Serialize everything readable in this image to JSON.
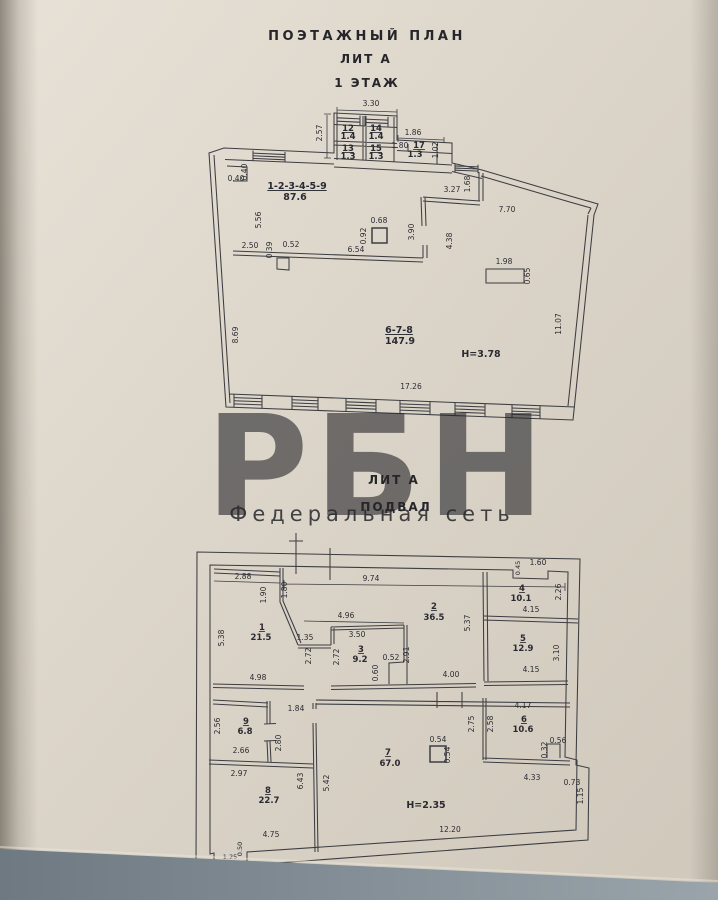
{
  "page": {
    "title_line1": "ПОЭТАЖНЫЙ ПЛАН",
    "title_line2": "ЛИТ А",
    "title_line3": "1 ЭТАЖ",
    "section2_line1": "ЛИТ А",
    "section2_line2": "ПОДВАЛ"
  },
  "watermark": {
    "brand": "РБН",
    "subtitle": "Федеральная сеть",
    "color": "#ef7d8d",
    "subtitle_color": "#8d8d88"
  },
  "floor1": {
    "height_note": "Н=3.78",
    "labels": [
      {
        "t": "3.30",
        "x": 371,
        "y": 106
      },
      {
        "t": "2.57",
        "x": 322,
        "y": 133,
        "r": 1
      },
      {
        "t": "12",
        "x": 348,
        "y": 131,
        "b": 1,
        "u": 1
      },
      {
        "t": "1.4",
        "x": 348,
        "y": 139,
        "b": 1
      },
      {
        "t": "14",
        "x": 376,
        "y": 131,
        "b": 1,
        "u": 1
      },
      {
        "t": "1.4",
        "x": 376,
        "y": 139,
        "b": 1
      },
      {
        "t": "13",
        "x": 348,
        "y": 151,
        "b": 1,
        "u": 1
      },
      {
        "t": "1.3",
        "x": 348,
        "y": 159,
        "b": 1
      },
      {
        "t": "15",
        "x": 376,
        "y": 151,
        "b": 1,
        "u": 1
      },
      {
        "t": "1.3",
        "x": 376,
        "y": 159,
        "b": 1
      },
      {
        "t": "1.86",
        "x": 413,
        "y": 135
      },
      {
        "t": "1.80",
        "x": 400,
        "y": 148
      },
      {
        "t": "17",
        "x": 419,
        "y": 148,
        "b": 1,
        "u": 1
      },
      {
        "t": "1.3",
        "x": 415,
        "y": 157,
        "b": 1
      },
      {
        "t": "1.02",
        "x": 438,
        "y": 150,
        "r": 1
      },
      {
        "t": "0.40",
        "x": 247,
        "y": 172,
        "r": 1
      },
      {
        "t": "0.40",
        "x": 236,
        "y": 181
      },
      {
        "t": "1-2-3-4-5-9",
        "x": 297,
        "y": 189,
        "b": 1,
        "u": 1,
        "s": 9.5
      },
      {
        "t": "87.6",
        "x": 295,
        "y": 200,
        "b": 1,
        "s": 9.5
      },
      {
        "t": "5.56",
        "x": 261,
        "y": 220,
        "r": 1
      },
      {
        "t": "2.50",
        "x": 250,
        "y": 248
      },
      {
        "t": "0.39",
        "x": 272,
        "y": 250,
        "r": 1
      },
      {
        "t": "0.52",
        "x": 291,
        "y": 247
      },
      {
        "t": "6.54",
        "x": 356,
        "y": 252
      },
      {
        "t": "0.68",
        "x": 379,
        "y": 223
      },
      {
        "t": "0.92",
        "x": 366,
        "y": 236,
        "r": 1
      },
      {
        "t": "3.90",
        "x": 414,
        "y": 232,
        "r": 1
      },
      {
        "t": "3.27",
        "x": 452,
        "y": 192
      },
      {
        "t": "1.68",
        "x": 470,
        "y": 184,
        "r": 1
      },
      {
        "t": "7.70",
        "x": 507,
        "y": 212
      },
      {
        "t": "4.38",
        "x": 452,
        "y": 241,
        "r": 1
      },
      {
        "t": "1.98",
        "x": 504,
        "y": 264
      },
      {
        "t": "0.65",
        "x": 530,
        "y": 276,
        "r": 1
      },
      {
        "t": "6-7-8",
        "x": 399,
        "y": 333,
        "b": 1,
        "u": 1,
        "s": 9.5
      },
      {
        "t": "147.9",
        "x": 400,
        "y": 344,
        "b": 1,
        "s": 9.5
      },
      {
        "t": "Н=3.78",
        "x": 481,
        "y": 357,
        "b": 1,
        "s": 9.5
      },
      {
        "t": "17.26",
        "x": 411,
        "y": 389
      },
      {
        "t": "8.69",
        "x": 238,
        "y": 335,
        "r": 1
      },
      {
        "t": "11.07",
        "x": 561,
        "y": 324,
        "r": 1
      }
    ]
  },
  "basement": {
    "height_note": "Н=2.35",
    "labels": [
      {
        "t": "2.88",
        "x": 243,
        "y": 579
      },
      {
        "t": "1.90",
        "x": 266,
        "y": 595,
        "r": 1
      },
      {
        "t": "1.80",
        "x": 287,
        "y": 590,
        "r": 1
      },
      {
        "t": "9.74",
        "x": 371,
        "y": 581
      },
      {
        "t": "0.45",
        "x": 520,
        "y": 568,
        "r": 1,
        "s": 6.5
      },
      {
        "t": "1.60",
        "x": 538,
        "y": 565
      },
      {
        "t": "5.38",
        "x": 224,
        "y": 638,
        "r": 1
      },
      {
        "t": "1",
        "x": 262,
        "y": 630,
        "b": 1,
        "u": 1
      },
      {
        "t": "21.5",
        "x": 261,
        "y": 640,
        "b": 1
      },
      {
        "t": "4.98",
        "x": 258,
        "y": 680
      },
      {
        "t": "4.96",
        "x": 346,
        "y": 618
      },
      {
        "t": "1.35",
        "x": 305,
        "y": 640
      },
      {
        "t": "3.50",
        "x": 357,
        "y": 637
      },
      {
        "t": "2.72",
        "x": 311,
        "y": 656,
        "r": 1
      },
      {
        "t": "2.72",
        "x": 339,
        "y": 657,
        "r": 1
      },
      {
        "t": "3",
        "x": 361,
        "y": 652,
        "b": 1,
        "u": 1
      },
      {
        "t": "9.2",
        "x": 360,
        "y": 662,
        "b": 1
      },
      {
        "t": "2",
        "x": 434,
        "y": 609,
        "b": 1,
        "u": 1
      },
      {
        "t": "36.5",
        "x": 434,
        "y": 620,
        "b": 1
      },
      {
        "t": "5.37",
        "x": 470,
        "y": 623,
        "r": 1
      },
      {
        "t": "2.91",
        "x": 409,
        "y": 655,
        "r": 1
      },
      {
        "t": "0.52",
        "x": 391,
        "y": 660
      },
      {
        "t": "0.60",
        "x": 378,
        "y": 673,
        "r": 1
      },
      {
        "t": "4.00",
        "x": 451,
        "y": 677
      },
      {
        "t": "4",
        "x": 522,
        "y": 591,
        "b": 1,
        "u": 1
      },
      {
        "t": "10.1",
        "x": 521,
        "y": 601,
        "b": 1
      },
      {
        "t": "4.15",
        "x": 531,
        "y": 612
      },
      {
        "t": "2.26",
        "x": 561,
        "y": 592,
        "r": 1
      },
      {
        "t": "5",
        "x": 523,
        "y": 641,
        "b": 1,
        "u": 1
      },
      {
        "t": "12.9",
        "x": 523,
        "y": 651,
        "b": 1
      },
      {
        "t": "3.10",
        "x": 559,
        "y": 653,
        "r": 1
      },
      {
        "t": "4.15",
        "x": 531,
        "y": 672
      },
      {
        "t": "1.84",
        "x": 296,
        "y": 711
      },
      {
        "t": "2.56",
        "x": 220,
        "y": 726,
        "r": 1
      },
      {
        "t": "9",
        "x": 246,
        "y": 724,
        "b": 1,
        "u": 1
      },
      {
        "t": "6.8",
        "x": 245,
        "y": 734,
        "b": 1
      },
      {
        "t": "2.66",
        "x": 241,
        "y": 753
      },
      {
        "t": "2.80",
        "x": 281,
        "y": 743,
        "r": 1
      },
      {
        "t": "2.97",
        "x": 239,
        "y": 776
      },
      {
        "t": "8",
        "x": 268,
        "y": 793,
        "b": 1,
        "u": 1
      },
      {
        "t": "22.7",
        "x": 269,
        "y": 803,
        "b": 1
      },
      {
        "t": "6.43",
        "x": 303,
        "y": 781,
        "r": 1
      },
      {
        "t": "5.42",
        "x": 329,
        "y": 783,
        "r": 1
      },
      {
        "t": "4.75",
        "x": 271,
        "y": 837
      },
      {
        "t": "1.25",
        "x": 230,
        "y": 859,
        "s": 6.5
      },
      {
        "t": "0.50",
        "x": 242,
        "y": 849,
        "r": 1,
        "s": 6.5
      },
      {
        "t": "7",
        "x": 388,
        "y": 755,
        "b": 1,
        "u": 1
      },
      {
        "t": "67.0",
        "x": 390,
        "y": 766,
        "b": 1
      },
      {
        "t": "0.54",
        "x": 438,
        "y": 742
      },
      {
        "t": "0.54",
        "x": 450,
        "y": 755,
        "r": 1
      },
      {
        "t": "Н=2.35",
        "x": 426,
        "y": 808,
        "b": 1,
        "s": 9.5
      },
      {
        "t": "12.20",
        "x": 450,
        "y": 832
      },
      {
        "t": "2.75",
        "x": 474,
        "y": 724,
        "r": 1
      },
      {
        "t": "2.58",
        "x": 493,
        "y": 724,
        "r": 1
      },
      {
        "t": "4.17",
        "x": 523,
        "y": 708
      },
      {
        "t": "6",
        "x": 524,
        "y": 722,
        "b": 1,
        "u": 1
      },
      {
        "t": "10.6",
        "x": 523,
        "y": 732,
        "b": 1
      },
      {
        "t": "0.32",
        "x": 547,
        "y": 750,
        "r": 1
      },
      {
        "t": "0.56",
        "x": 558,
        "y": 743
      },
      {
        "t": "4.33",
        "x": 532,
        "y": 780
      },
      {
        "t": "0.73",
        "x": 572,
        "y": 785
      },
      {
        "t": "1.15",
        "x": 583,
        "y": 796,
        "r": 1
      }
    ]
  }
}
